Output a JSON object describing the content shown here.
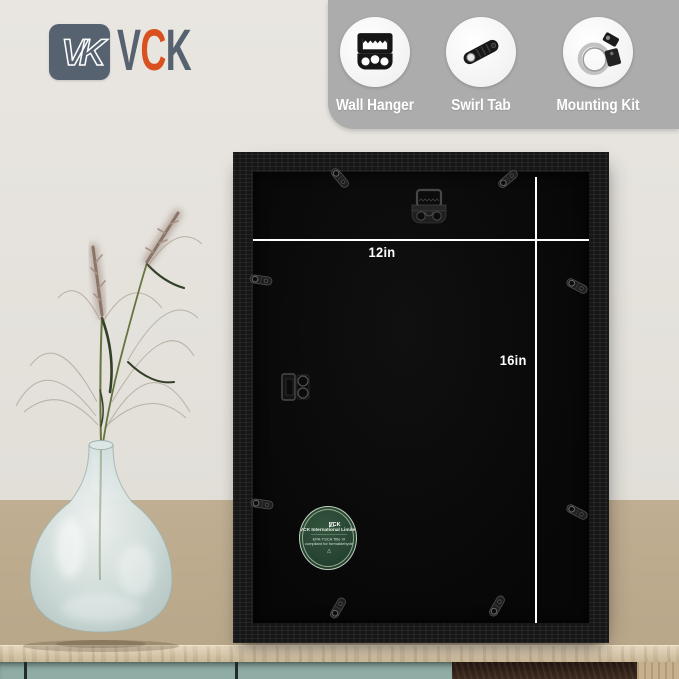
{
  "brand": {
    "monogram": "VK",
    "letters": [
      {
        "ch": "V"
      },
      {
        "ch": "C"
      },
      {
        "ch": "K"
      }
    ]
  },
  "features": {
    "items": [
      {
        "label": "Wall Hanger",
        "icon": "wall-hanger-icon"
      },
      {
        "label": "Swirl Tab",
        "icon": "swirl-tab-icon"
      },
      {
        "label": "Mounting Kit",
        "icon": "mounting-kit-icon"
      }
    ]
  },
  "frame": {
    "width_label": "12in",
    "height_label": "16in",
    "sticker": {
      "brand": "VCK",
      "line1": "VCK International Limited",
      "line2": "EPA-TSCA Title VI",
      "line3": "compliant for formaldehyde",
      "emblem": "△"
    }
  },
  "colors": {
    "brand_slate": "#566270",
    "brand_accent": "#d8511f",
    "panel_gray": "#acacac",
    "label_white": "#ffffff",
    "wall_upper": "#e6e3de",
    "wall_lower": "#b9a78a",
    "frame_black": "#161616",
    "backing_black": "#070707",
    "line_white": "#ffffff",
    "sticker_green": "#23402f",
    "table_wood": "#dbc8a6",
    "cabinet_teal": "#8fada4",
    "hardware_gray": "#4a4a4a"
  }
}
